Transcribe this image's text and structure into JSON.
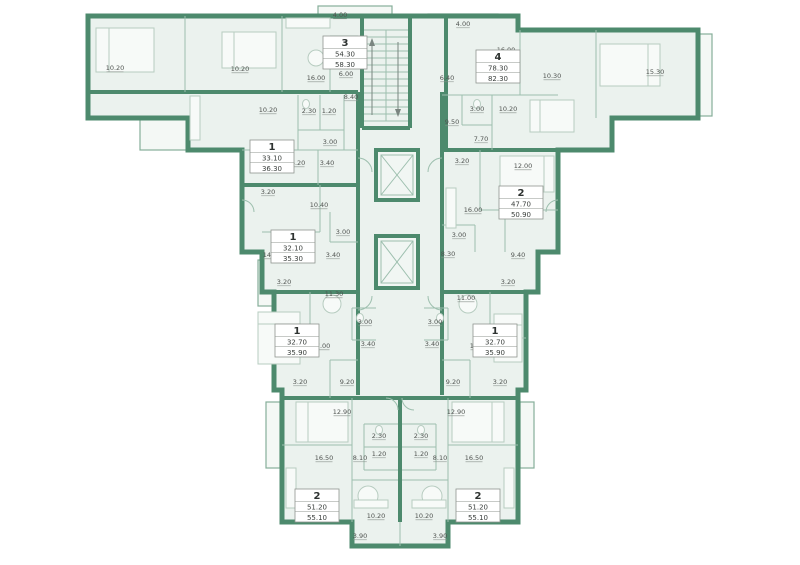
{
  "plan": {
    "colors": {
      "wall": "#4d8a6d",
      "room": "#ebf2ee",
      "thin": "#9dbfae",
      "furn": "#b7ccc0",
      "balc": "#85ae99",
      "txt": "#4f5350"
    },
    "apartments": [
      {
        "number": "3",
        "area_living": "54.30",
        "area_total": "58.30",
        "x": 345,
        "y": 36
      },
      {
        "number": "4",
        "area_living": "78.30",
        "area_total": "82.30",
        "x": 498,
        "y": 50
      },
      {
        "number": "1",
        "area_living": "33.10",
        "area_total": "36.30",
        "x": 272,
        "y": 140
      },
      {
        "number": "2",
        "area_living": "47.70",
        "area_total": "50.90",
        "x": 521,
        "y": 186
      },
      {
        "number": "1",
        "area_living": "32.10",
        "area_total": "35.30",
        "x": 293,
        "y": 230
      },
      {
        "number": "1",
        "area_living": "32.70",
        "area_total": "35.90",
        "x": 297,
        "y": 324
      },
      {
        "number": "1",
        "area_living": "32.70",
        "area_total": "35.90",
        "x": 495,
        "y": 324
      },
      {
        "number": "2",
        "area_living": "51.20",
        "area_total": "55.10",
        "x": 317,
        "y": 489
      },
      {
        "number": "2",
        "area_living": "51.20",
        "area_total": "55.10",
        "x": 478,
        "y": 489
      }
    ],
    "room_labels": [
      {
        "text": "4.00",
        "x": 340,
        "y": 17
      },
      {
        "text": "4.00",
        "x": 463,
        "y": 26
      },
      {
        "text": "10.20",
        "x": 115,
        "y": 70
      },
      {
        "text": "10.20",
        "x": 240,
        "y": 71
      },
      {
        "text": "16.00",
        "x": 316,
        "y": 80
      },
      {
        "text": "6.00",
        "x": 346,
        "y": 76
      },
      {
        "text": "8.40",
        "x": 351,
        "y": 99
      },
      {
        "text": "16.00",
        "x": 506,
        "y": 52
      },
      {
        "text": "15.30",
        "x": 655,
        "y": 74
      },
      {
        "text": "10.30",
        "x": 552,
        "y": 78
      },
      {
        "text": "6.40",
        "x": 447,
        "y": 80
      },
      {
        "text": "3.00",
        "x": 477,
        "y": 111
      },
      {
        "text": "10.20",
        "x": 508,
        "y": 111
      },
      {
        "text": "9.50",
        "x": 452,
        "y": 124
      },
      {
        "text": "7.70",
        "x": 481,
        "y": 141
      },
      {
        "text": "3.20",
        "x": 462,
        "y": 163
      },
      {
        "text": "12.00",
        "x": 523,
        "y": 168
      },
      {
        "text": "2.30",
        "x": 309,
        "y": 113
      },
      {
        "text": "1.20",
        "x": 329,
        "y": 113
      },
      {
        "text": "10.20",
        "x": 268,
        "y": 112
      },
      {
        "text": "3.00",
        "x": 330,
        "y": 144
      },
      {
        "text": "16.20",
        "x": 296,
        "y": 165
      },
      {
        "text": "3.40",
        "x": 327,
        "y": 165
      },
      {
        "text": "3.20",
        "x": 268,
        "y": 194
      },
      {
        "text": "10.40",
        "x": 319,
        "y": 207
      },
      {
        "text": "3.00",
        "x": 343,
        "y": 234
      },
      {
        "text": "14.40",
        "x": 272,
        "y": 257
      },
      {
        "text": "3.40",
        "x": 333,
        "y": 257
      },
      {
        "text": "3.20",
        "x": 284,
        "y": 284
      },
      {
        "text": "11.30",
        "x": 334,
        "y": 296
      },
      {
        "text": "3.00",
        "x": 365,
        "y": 324
      },
      {
        "text": "17.00",
        "x": 321,
        "y": 348
      },
      {
        "text": "3.40",
        "x": 368,
        "y": 346
      },
      {
        "text": "3.20",
        "x": 300,
        "y": 384
      },
      {
        "text": "9.20",
        "x": 347,
        "y": 384
      },
      {
        "text": "16.00",
        "x": 473,
        "y": 212
      },
      {
        "text": "3.00",
        "x": 459,
        "y": 237
      },
      {
        "text": "8.30",
        "x": 448,
        "y": 256
      },
      {
        "text": "9.40",
        "x": 518,
        "y": 257
      },
      {
        "text": "3.20",
        "x": 508,
        "y": 284
      },
      {
        "text": "11.00",
        "x": 466,
        "y": 300
      },
      {
        "text": "3.00",
        "x": 435,
        "y": 324
      },
      {
        "text": "3.40",
        "x": 432,
        "y": 346
      },
      {
        "text": "17.00",
        "x": 479,
        "y": 348
      },
      {
        "text": "3.20",
        "x": 500,
        "y": 384
      },
      {
        "text": "9.20",
        "x": 453,
        "y": 384
      },
      {
        "text": "12.90",
        "x": 342,
        "y": 414
      },
      {
        "text": "12.90",
        "x": 456,
        "y": 414
      },
      {
        "text": "16.50",
        "x": 324,
        "y": 460
      },
      {
        "text": "16.50",
        "x": 474,
        "y": 460
      },
      {
        "text": "8.10",
        "x": 360,
        "y": 460
      },
      {
        "text": "8.10",
        "x": 440,
        "y": 460
      },
      {
        "text": "2.30",
        "x": 379,
        "y": 438
      },
      {
        "text": "2.30",
        "x": 421,
        "y": 438
      },
      {
        "text": "1.20",
        "x": 379,
        "y": 456
      },
      {
        "text": "1.20",
        "x": 421,
        "y": 456
      },
      {
        "text": "10.20",
        "x": 376,
        "y": 518
      },
      {
        "text": "10.20",
        "x": 424,
        "y": 518
      },
      {
        "text": "3.90",
        "x": 360,
        "y": 538
      },
      {
        "text": "3.90",
        "x": 440,
        "y": 538
      }
    ]
  }
}
